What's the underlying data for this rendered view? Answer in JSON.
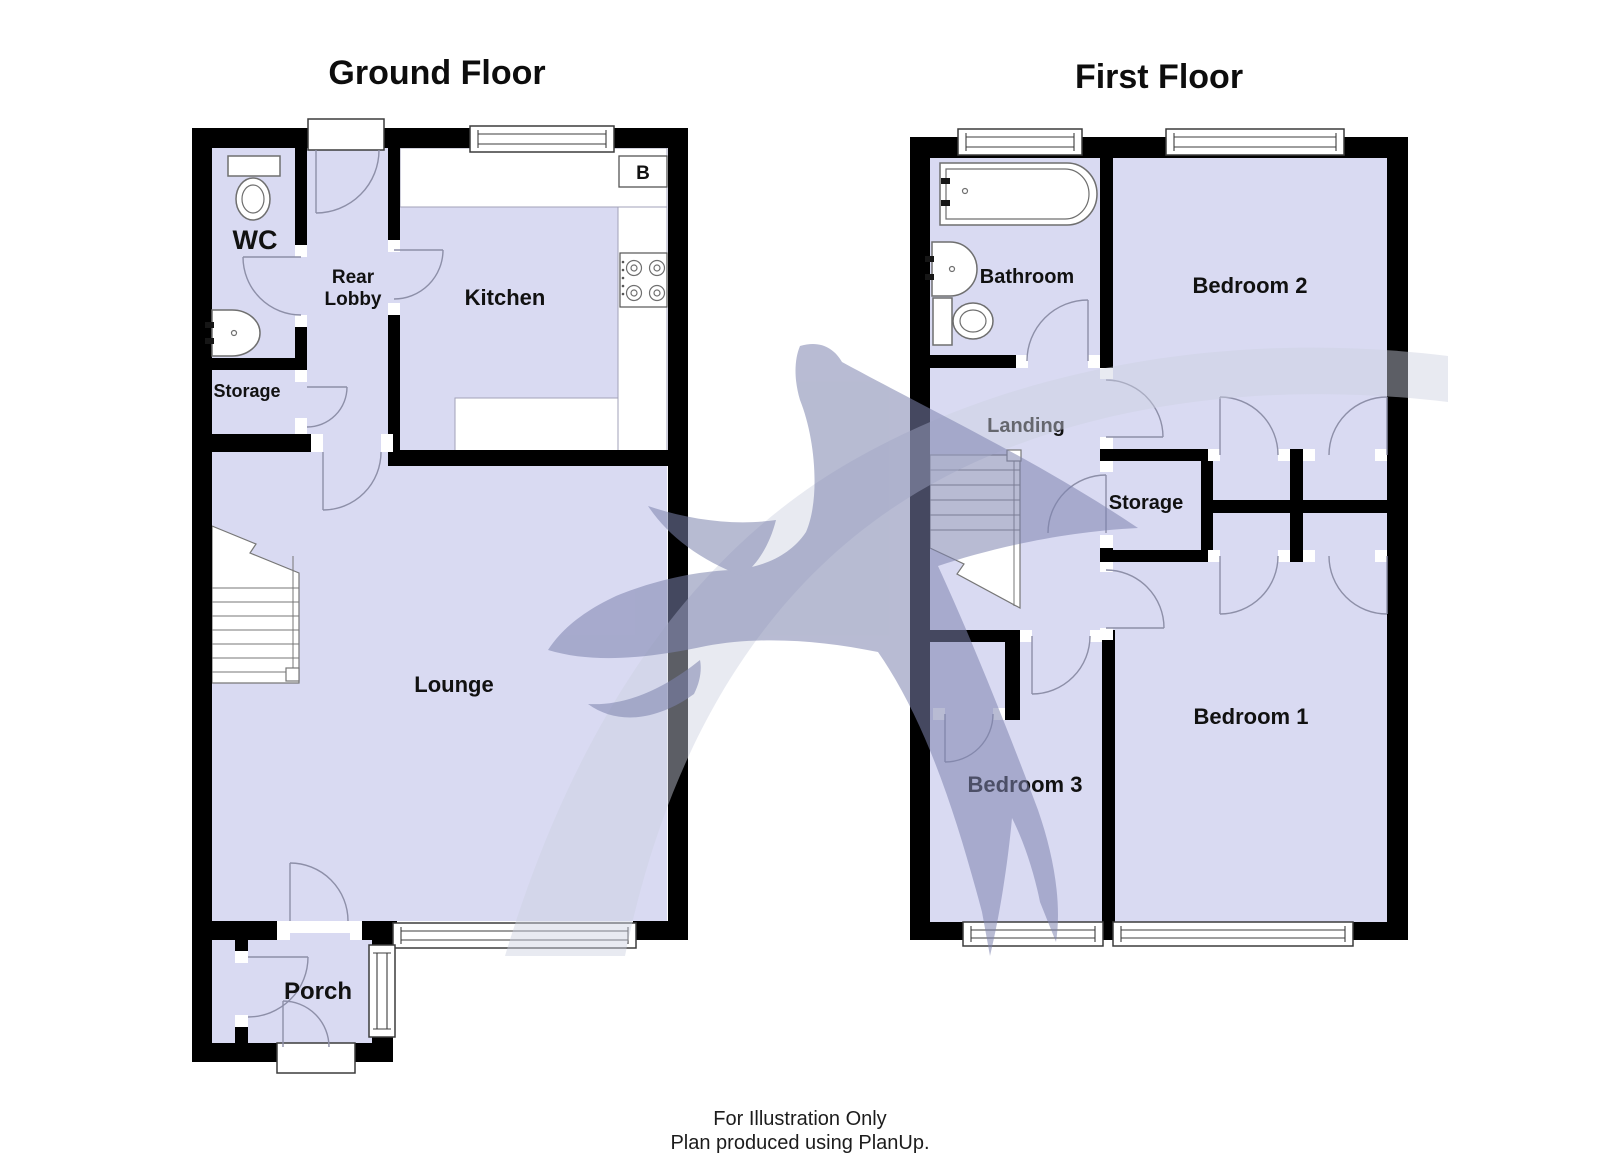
{
  "ground_floor": {
    "title": "Ground Floor",
    "rooms": {
      "wc": "WC",
      "rear_lobby_line1": "Rear",
      "rear_lobby_line2": "Lobby",
      "kitchen": "Kitchen",
      "storage": "Storage",
      "lounge": "Lounge",
      "porch": "Porch"
    },
    "boiler_label": "B"
  },
  "first_floor": {
    "title": "First Floor",
    "rooms": {
      "bathroom": "Bathroom",
      "bedroom_2": "Bedroom 2",
      "landing": "Landing",
      "storage": "Storage",
      "bedroom_1": "Bedroom 1",
      "bedroom_3": "Bedroom 3"
    }
  },
  "footer": {
    "line1": "For Illustration Only",
    "line2": "Plan produced using PlanUp."
  },
  "symbols": [
    "toilet",
    "sink",
    "bath",
    "hob",
    "boiler-box",
    "stairs",
    "window",
    "door-arc",
    "swallow-watermark"
  ],
  "colors": {
    "background": "#ffffff",
    "room_fill": "#d9daf2",
    "wall": "#000000",
    "door_arc": "#8d8fa8",
    "fixture_stroke": "#6f6f6f",
    "window_stroke": "#3c3c3c",
    "label_text": "#111111",
    "watermark_bird": "#7d84ae",
    "watermark_swoosh": "#ccd0e0"
  }
}
